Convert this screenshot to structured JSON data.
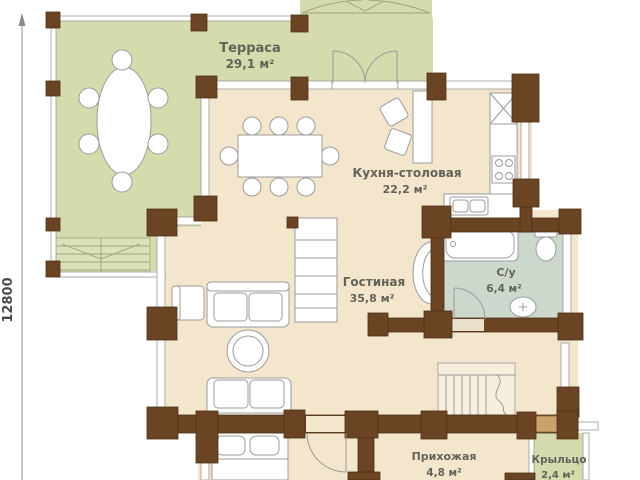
{
  "rooms": {
    "terrace": {
      "name": "Терраса",
      "area": "29,1 м²"
    },
    "kitchen_dining": {
      "name": "Кухня-столовая",
      "area": "22,2 м²"
    },
    "living": {
      "name": "Гостиная",
      "area": "35,8 м²"
    },
    "bathroom": {
      "name": "С/у",
      "area": "6,4 м²"
    },
    "hallway": {
      "name": "Прихожая",
      "area": "4,8 м²"
    },
    "porch": {
      "name": "Крыльцо",
      "area": "2,4 м²"
    }
  },
  "dimensions": {
    "left_total": "12800"
  },
  "colors": {
    "terrace_fill": "#d6dbad",
    "steps_fill": "#dde1ba",
    "floor_fill": "#f4e6cc",
    "bathroom_fill": "#ccd8cb",
    "porch_fill": "#d6dbad",
    "wall_brown": "#6b4423"
  }
}
